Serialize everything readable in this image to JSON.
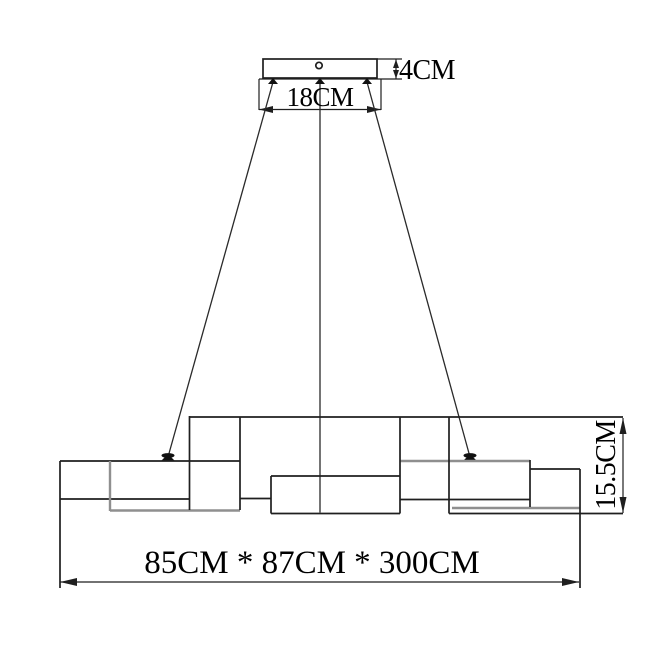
{
  "labels": {
    "canopy_width": "18CM",
    "canopy_height": "4CM",
    "body_height": "15.5CM",
    "overall_size": "85CM * 87CM * 300CM"
  },
  "colors": {
    "line": "#1f1f1f",
    "secondary_line": "#8f8f8f",
    "background": "#ffffff"
  }
}
